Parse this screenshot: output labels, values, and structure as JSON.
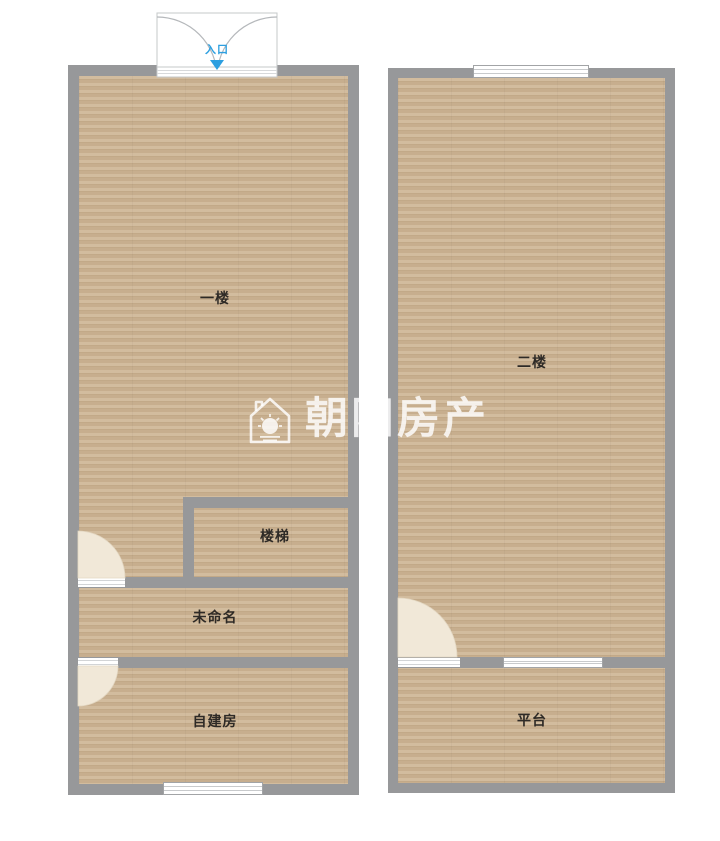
{
  "watermark": {
    "text": "朝阳房产",
    "icon": "house-sun-logo"
  },
  "entrance": {
    "label": "入口",
    "arrow_icon": "down-triangle"
  },
  "floor_plans": [
    {
      "name": "first-floor",
      "rooms": [
        {
          "id": "main",
          "label": "一楼"
        },
        {
          "id": "stairs",
          "label": "楼梯"
        },
        {
          "id": "unnamed",
          "label": "未命名"
        },
        {
          "id": "self-built",
          "label": "自建房"
        }
      ]
    },
    {
      "name": "second-floor",
      "rooms": [
        {
          "id": "main",
          "label": "二楼"
        },
        {
          "id": "platform",
          "label": "平台"
        }
      ]
    }
  ],
  "colors": {
    "wall": "#97989a",
    "floor_base": "#cdb493",
    "floor_stripe_light": "#d4bc9d",
    "floor_stripe_dark": "#c7ac89",
    "door_swing": "#f1e8d8",
    "entrance_accent": "#2d9fe0",
    "label_text": "#2e2a26",
    "watermark": "#ffffff"
  }
}
